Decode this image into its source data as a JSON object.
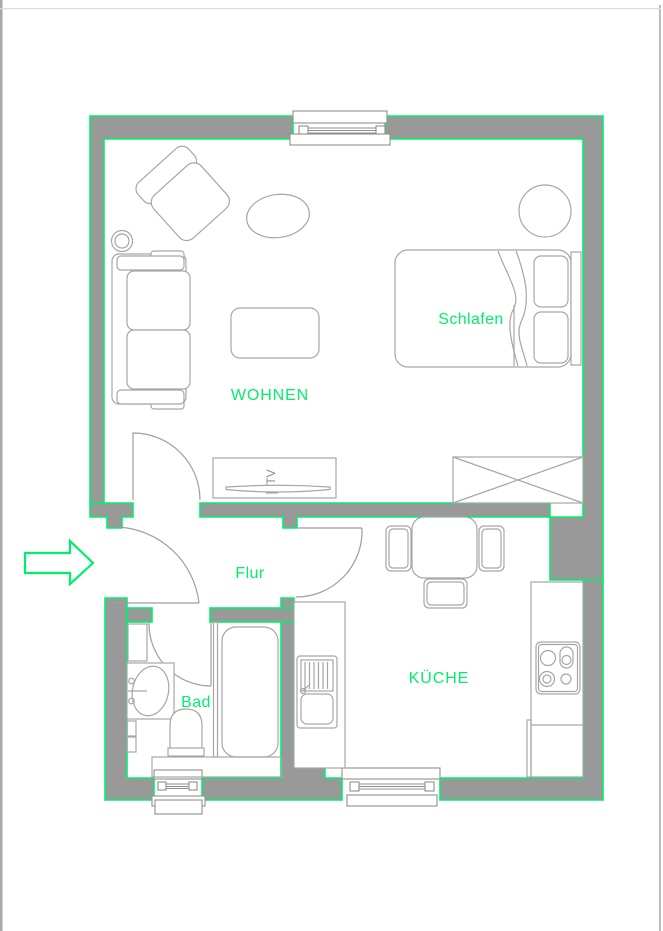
{
  "plan": {
    "rooms": {
      "wohnen": {
        "label": "WOHNEN"
      },
      "schlafen": {
        "label": "Schlafen"
      },
      "flur": {
        "label": "Flur"
      },
      "bad": {
        "label": "Bad"
      },
      "kueche": {
        "label": "KÜCHE"
      }
    },
    "annotations": {
      "tv_label": "TV"
    },
    "icons": {
      "entrance_arrow": "arrow-right-icon"
    },
    "colors": {
      "wall_fill": "#999999",
      "outline_green": "#00f06e",
      "label_green": "#00ef6a",
      "furniture_stroke": "#a6a6a6",
      "page_background": "#ffffff"
    }
  }
}
